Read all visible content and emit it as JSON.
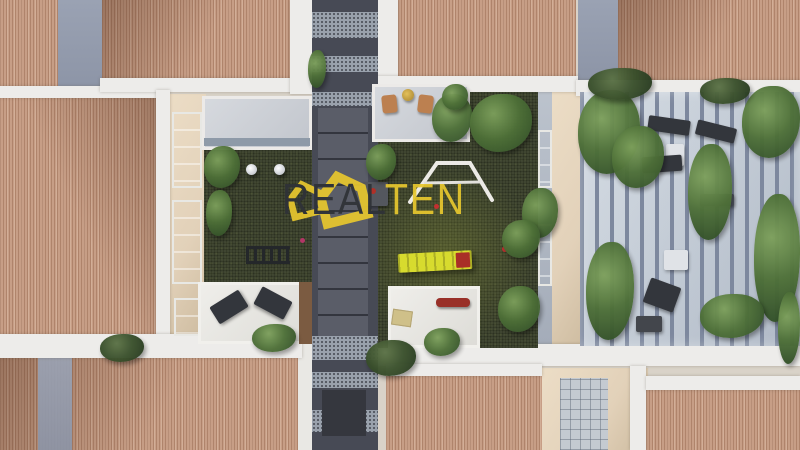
{
  "meta": {
    "title": "Aerial 3D architectural rendering of a residential complex courtyard",
    "type": "architectural-visualization"
  },
  "watermark": {
    "icon": "realten-double-house-icon",
    "text_primary": "REAL",
    "text_accent": "TEN"
  },
  "palette": {
    "roof_base": "#c79e86",
    "roof_stripe": "#a77c62",
    "parapet": "#edecea",
    "wall_beige": "#e2d1b9",
    "wall_blue": "#8c94a6",
    "walkway": "#474a55",
    "walkway_mid": "#5a5d68",
    "pebble": "#99a1ac",
    "lawn": "#3f4531",
    "lawn_bright": "#5a6430",
    "pergola_floor": "#bcc5d0",
    "pergola_slat": "#7d889e",
    "plant_light": "#7da05c",
    "plant_mid": "#4e7038",
    "plant_dark": "#2f4c26",
    "lounger_yellow": "#d7db2e",
    "pillow_red": "#a92f27",
    "furniture_dark": "#33363c",
    "wood_brown": "#7b5b41",
    "glass_blue": "#8496ac",
    "logo_yellow": "#e7c72e",
    "logo_dark": "#2f3237"
  },
  "scene": {
    "elements": [
      "terracotta-tiled-roofs",
      "white-parapet-walls",
      "central-paved-walkway",
      "courtyard-lawns",
      "white-garden-table",
      "pendant-lamps",
      "garden-railing",
      "balcony-with-lounge-cushions",
      "terrace-with-wooden-chairs",
      "yellow-sun-lounger-with-red-pillow",
      "slatted-pergola-terrace",
      "outdoor-furniture-set",
      "potted-plants-and-climbing-greenery",
      "facade-glass-windows"
    ]
  }
}
